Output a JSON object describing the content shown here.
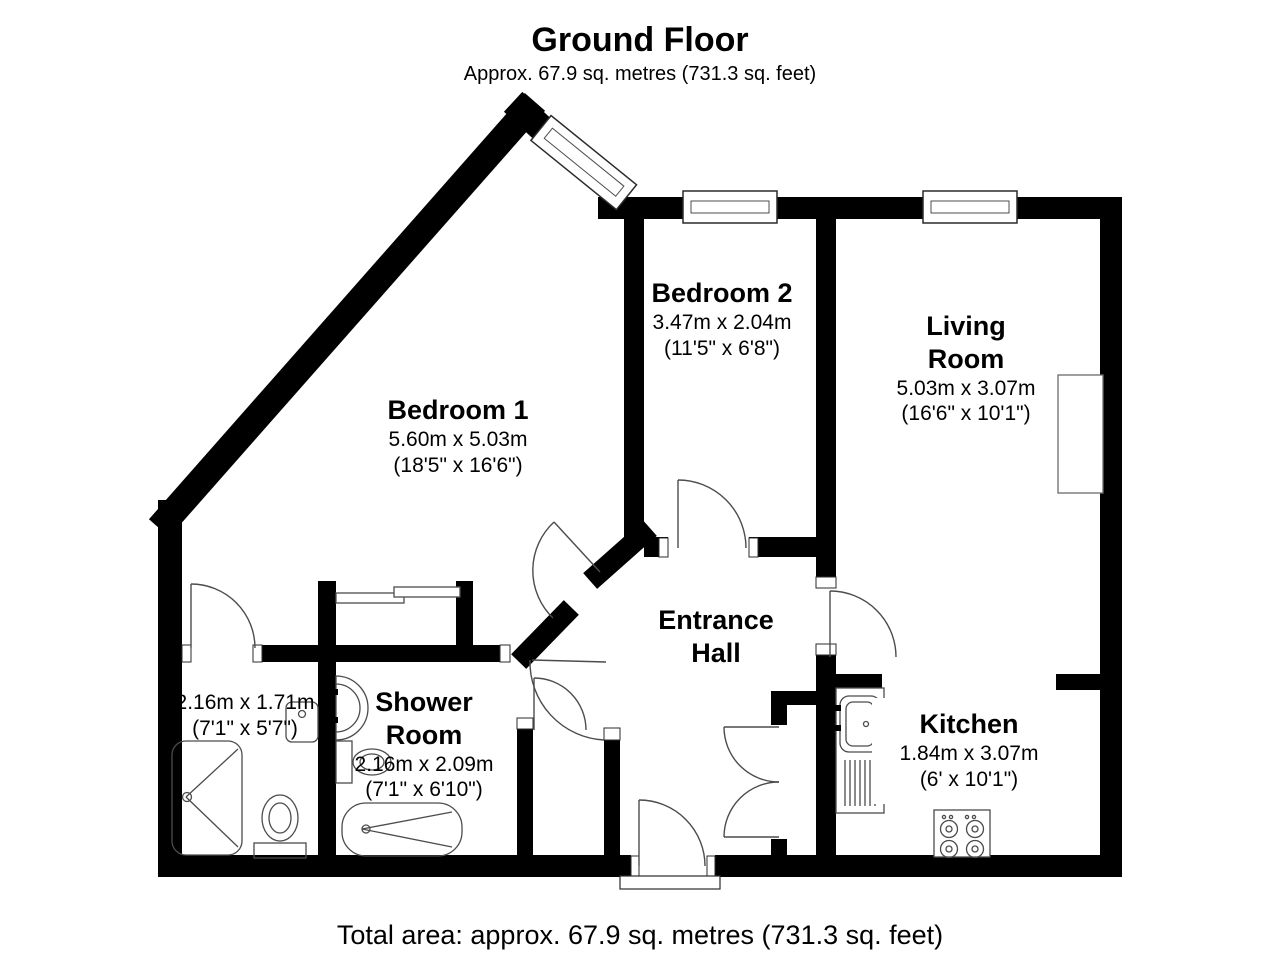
{
  "header": {
    "title": "Ground Floor",
    "subtitle": "Approx. 67.9 sq. metres (731.3 sq. feet)"
  },
  "footer": {
    "total_area": "Total area: approx. 67.9 sq. metres (731.3 sq. feet)"
  },
  "rooms": {
    "bedroom1": {
      "name": "Bedroom 1",
      "metric": "5.60m x 5.03m",
      "imperial": "(18'5\" x 16'6\")"
    },
    "bedroom2": {
      "name": "Bedroom 2",
      "metric": "3.47m x 2.04m",
      "imperial": "(11'5\" x 6'8\")"
    },
    "living": {
      "name": "Living\nRoom",
      "metric": "5.03m x 3.07m",
      "imperial": "(16'6\" x 10'1\")"
    },
    "hall": {
      "name": "Entrance\nHall"
    },
    "shower": {
      "name": "Shower\nRoom",
      "metric": "2.16m x 2.09m",
      "imperial": "(7'1\" x 6'10\")"
    },
    "ensuite": {
      "metric": "2.16m x 1.71m",
      "imperial": "(7'1\" x 5'7\")"
    },
    "kitchen": {
      "name": "Kitchen",
      "metric": "1.84m x 3.07m",
      "imperial": "(6' x 10'1\")"
    }
  },
  "colors": {
    "wall": "#000000",
    "fixture_line": "#4c4c4c",
    "background": "#ffffff"
  }
}
